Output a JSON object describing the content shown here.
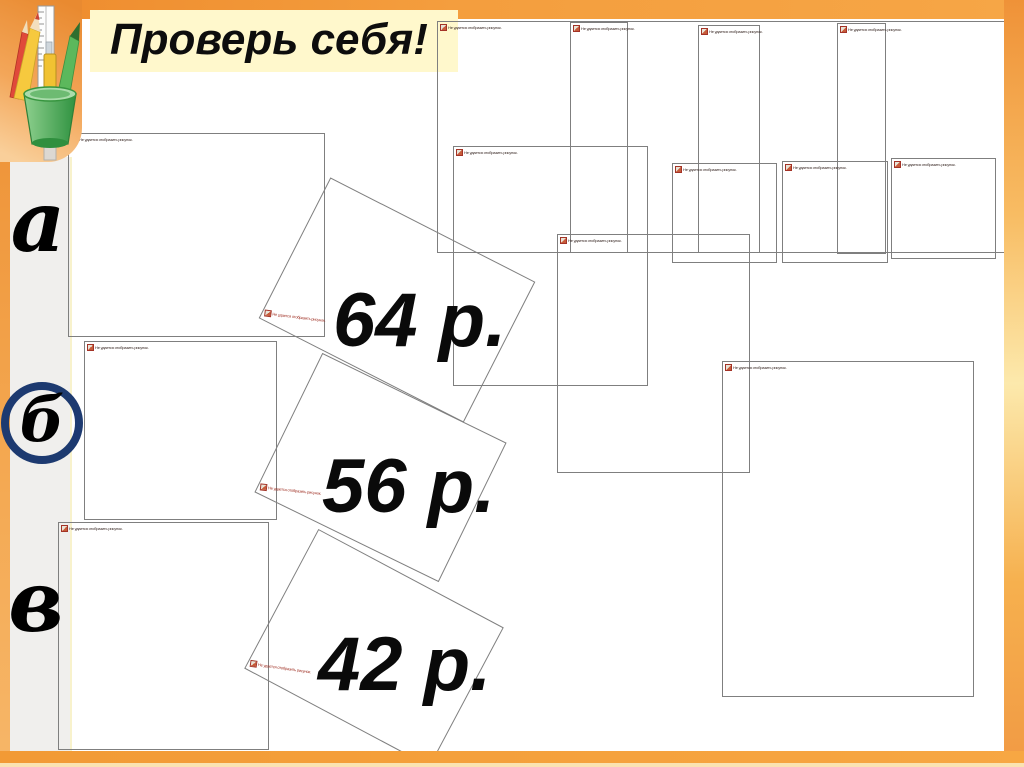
{
  "slide": {
    "title": "Проверь себя!",
    "rows": [
      {
        "label": "а"
      },
      {
        "label": "б"
      },
      {
        "label": "в"
      }
    ],
    "prices": [
      {
        "value": "64 р."
      },
      {
        "value": "56 р."
      },
      {
        "value": "42 р."
      }
    ],
    "placeholder_text": "Не удается отобразить рисунок.",
    "colors": {
      "frame_orange": "#f49a3c",
      "frame_cream": "#fae3b2",
      "banner_yellow": "#fff8cc",
      "strip_gray": "#f0efed",
      "circle_navy": "#1d3a70",
      "box_border": "#7f7f7f",
      "placeholder_red": "#a33327",
      "text_black": "#0a0a0a"
    }
  }
}
